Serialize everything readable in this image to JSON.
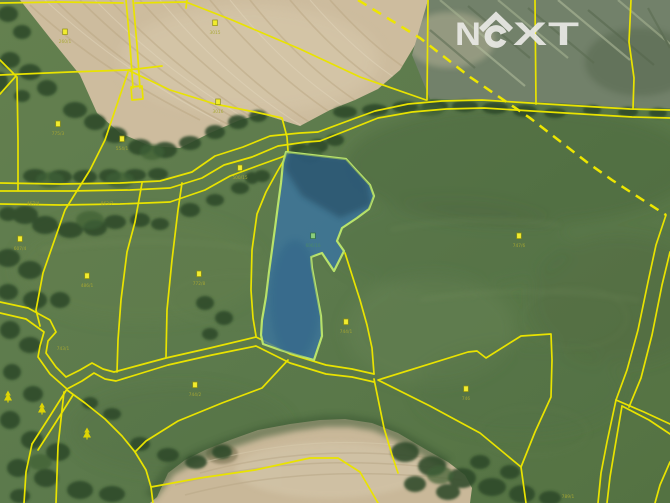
{
  "watermark": {
    "brand": "NEXT",
    "color": "#e9e9e5",
    "letters": [
      {
        "ch": "N",
        "x": 455,
        "w": 26
      },
      {
        "ch": "X",
        "x": 513,
        "w": 34
      },
      {
        "ch": "T",
        "x": 548,
        "w": 31
      }
    ]
  },
  "map": {
    "type": "cadastral-aerial-map",
    "colors": {
      "boundary_line": "#e9e300",
      "dashed_line": "#ede600",
      "highlight_fill": "#3b74a0",
      "highlight_outline": "#b9e36a",
      "label_square_fill": "#f2ec2e",
      "label_square_stroke": "#8f8f10",
      "label_text": "#a8a832",
      "highlight_square_fill": "#8ccd7c",
      "highlight_square_stroke": "#2f6f3f",
      "highlight_label_text": "#4a8a6a",
      "tree_symbol": "#e6da00"
    },
    "highlight_parcel": {
      "label": "606/16"
    },
    "parcel_labels": [
      {
        "text": "3015",
        "x": 215,
        "y": 34,
        "square": true,
        "kind": "standard"
      },
      {
        "text": "260/1",
        "x": 65,
        "y": 43,
        "square": true,
        "kind": "standard"
      },
      {
        "text": "3016",
        "x": 218,
        "y": 113,
        "square": true,
        "kind": "standard"
      },
      {
        "text": "775/3",
        "x": 58,
        "y": 135,
        "square": true,
        "kind": "standard"
      },
      {
        "text": "554/1",
        "x": 122,
        "y": 150,
        "square": true,
        "kind": "standard"
      },
      {
        "text": "500/15",
        "x": 240,
        "y": 179,
        "square": true,
        "kind": "standard"
      },
      {
        "text": "863/7",
        "x": 107,
        "y": 205,
        "square": false,
        "kind": "standard"
      },
      {
        "text": "467/4",
        "x": 33,
        "y": 205,
        "square": false,
        "kind": "standard"
      },
      {
        "text": "607/4",
        "x": 20,
        "y": 250,
        "square": true,
        "kind": "standard"
      },
      {
        "text": "486/1",
        "x": 87,
        "y": 287,
        "square": true,
        "kind": "standard"
      },
      {
        "text": "772/8",
        "x": 199,
        "y": 285,
        "square": true,
        "kind": "standard"
      },
      {
        "text": "743/1",
        "x": 63,
        "y": 350,
        "square": false,
        "kind": "standard"
      },
      {
        "text": "744/2",
        "x": 195,
        "y": 396,
        "square": true,
        "kind": "standard"
      },
      {
        "text": "744/1",
        "x": 346,
        "y": 333,
        "square": true,
        "kind": "standard"
      },
      {
        "text": "747/6",
        "x": 519,
        "y": 247,
        "square": true,
        "kind": "standard"
      },
      {
        "text": "746",
        "x": 466,
        "y": 400,
        "square": true,
        "kind": "standard"
      },
      {
        "text": "789/1",
        "x": 568,
        "y": 498,
        "square": false,
        "kind": "standard"
      },
      {
        "text": "606/16",
        "x": 313,
        "y": 247,
        "square": true,
        "kind": "highlight"
      }
    ],
    "tree_symbols": [
      {
        "x": 8,
        "y": 397
      },
      {
        "x": 42,
        "y": 409
      },
      {
        "x": 87,
        "y": 434
      }
    ]
  }
}
